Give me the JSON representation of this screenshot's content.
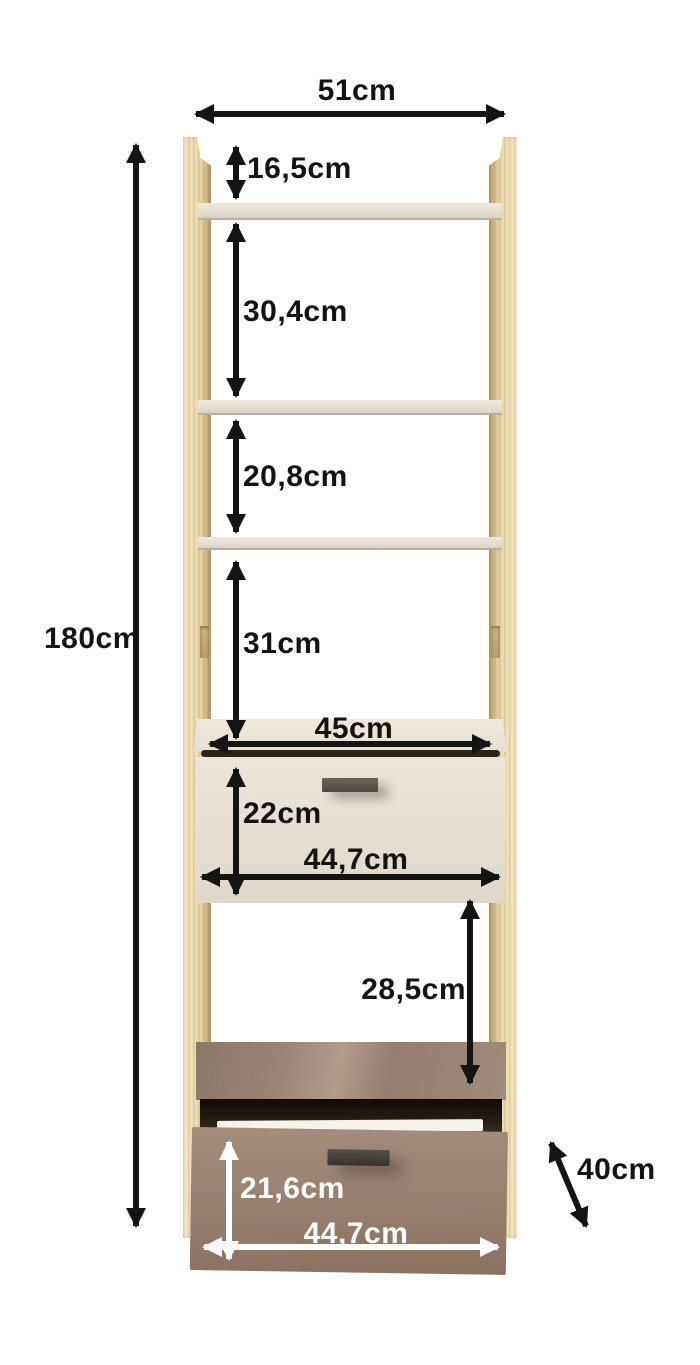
{
  "diagram": {
    "subject": "tall open shelf unit with middle and bottom drawer",
    "dimensions": {
      "top_width": "51cm",
      "total_height": "180cm",
      "top_offset": "16,5cm",
      "shelf_gap_1": "30,4cm",
      "shelf_gap_2": "20,8cm",
      "shelf_gap_3": "31cm",
      "cabinet_inner_width": "45cm",
      "middle_drawer_height": "22cm",
      "middle_drawer_front_width": "44,7cm",
      "open_compartment_height": "28,5cm",
      "bottom_drawer_height": "21,6cm",
      "bottom_drawer_front_width": "44,7cm",
      "depth": "40cm"
    },
    "colors": {
      "background": "#ffffff",
      "wood": "#ead9ab",
      "shelf_cream": "#e4dfd2",
      "drawer_taupe": "#9a8170",
      "opening_dark": "#1c140c",
      "handle_dark": "#4e4a43",
      "annotation_black": "#141414",
      "annotation_white": "#ffffff"
    }
  }
}
